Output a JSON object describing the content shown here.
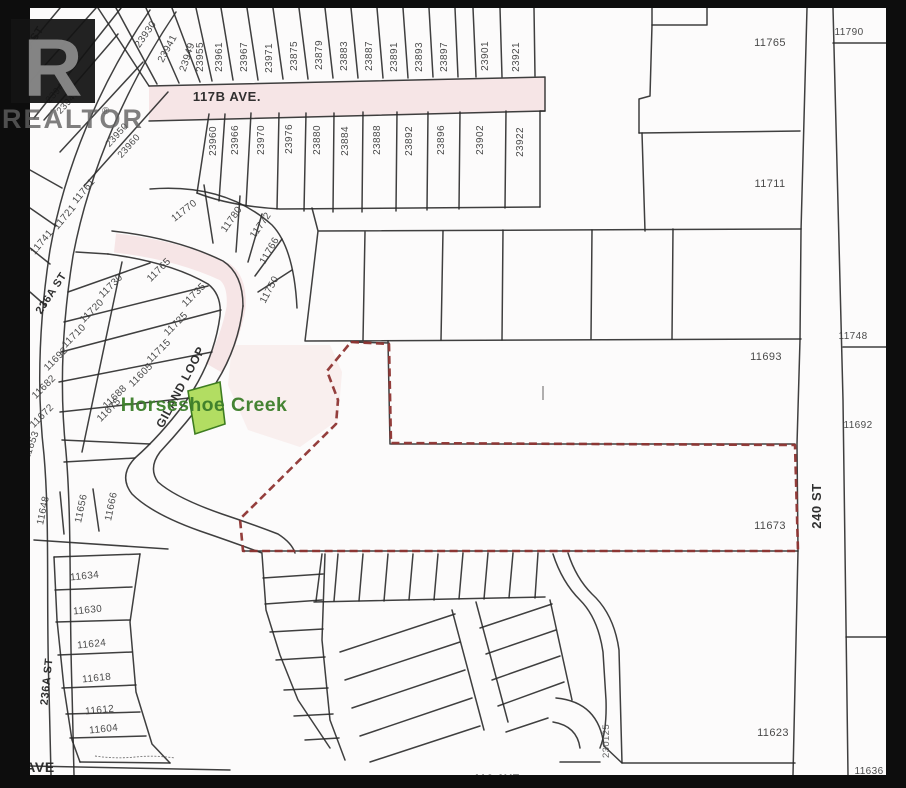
{
  "watermark": {
    "letter": "R",
    "text": "REALTOR",
    "reg": "®"
  },
  "subject_parcel": {
    "lot": "11673",
    "boundary_style": "red-dashed"
  },
  "poi": {
    "creek_label": "Horseshoe Creek"
  },
  "colors": {
    "frame": "#0d0d0d",
    "paper": "#fcfbfb",
    "parcel_line": "#2a2a2a",
    "boundary_dash": "#8e3432",
    "green_lot_fill": "#b2dd62",
    "green_lot_stroke": "#3e7d20",
    "creek_text": "#3c7e2a",
    "road_tint": "#f6e5e6"
  },
  "labels": [
    {
      "t": "117B AVE.",
      "x": 227,
      "y": 101,
      "r": 0,
      "s": 13,
      "cls": "street"
    },
    {
      "t": "240 ST",
      "x": 821,
      "y": 506,
      "r": -90,
      "s": 13,
      "cls": "street"
    },
    {
      "t": "236A ST",
      "x": 54,
      "y": 295,
      "r": -57,
      "s": 11,
      "cls": "street"
    },
    {
      "t": "236A ST",
      "x": 50,
      "y": 682,
      "r": -84,
      "s": 11,
      "cls": "street"
    },
    {
      "t": "GILAND LOOP",
      "x": 184,
      "y": 389,
      "r": -62,
      "s": 12,
      "cls": "street"
    },
    {
      "t": "9 ST",
      "x": 37,
      "y": 40,
      "r": -57,
      "s": 11,
      "cls": "street"
    },
    {
      "t": "AVE",
      "x": 40,
      "y": 772,
      "r": 0,
      "s": 14,
      "cls": "street"
    },
    {
      "t": "116 AVE",
      "x": 497,
      "y": 782,
      "r": 0,
      "s": 11,
      "cls": "street"
    },
    {
      "t": "Horseshoe Creek",
      "x": 204,
      "y": 411,
      "r": 0,
      "s": 19.5,
      "cls": "creek"
    },
    {
      "t": "23930",
      "x": 148,
      "y": 36,
      "r": -55,
      "s": 10,
      "cls": "lot"
    },
    {
      "t": "23941",
      "x": 170,
      "y": 50,
      "r": -62,
      "s": 10,
      "cls": "lot"
    },
    {
      "t": "23949",
      "x": 190,
      "y": 58,
      "r": -72,
      "s": 10,
      "cls": "lot"
    },
    {
      "t": "23955",
      "x": 203,
      "y": 57,
      "r": -90,
      "s": 10,
      "cls": "lot"
    },
    {
      "t": "23961",
      "x": 222,
      "y": 57,
      "r": -90,
      "s": 10,
      "cls": "lot"
    },
    {
      "t": "23967",
      "x": 247,
      "y": 57,
      "r": -90,
      "s": 10,
      "cls": "lot"
    },
    {
      "t": "23971",
      "x": 272,
      "y": 58,
      "r": -90,
      "s": 10,
      "cls": "lot"
    },
    {
      "t": "23875",
      "x": 297,
      "y": 56,
      "r": -90,
      "s": 10,
      "cls": "lot"
    },
    {
      "t": "23879",
      "x": 322,
      "y": 55,
      "r": -90,
      "s": 10,
      "cls": "lot"
    },
    {
      "t": "23883",
      "x": 347,
      "y": 56,
      "r": -90,
      "s": 10,
      "cls": "lot"
    },
    {
      "t": "23887",
      "x": 372,
      "y": 56,
      "r": -90,
      "s": 10,
      "cls": "lot"
    },
    {
      "t": "23891",
      "x": 397,
      "y": 57,
      "r": -90,
      "s": 10,
      "cls": "lot"
    },
    {
      "t": "23893",
      "x": 422,
      "y": 57,
      "r": -90,
      "s": 10,
      "cls": "lot"
    },
    {
      "t": "23897",
      "x": 447,
      "y": 57,
      "r": -90,
      "s": 10,
      "cls": "lot"
    },
    {
      "t": "23901",
      "x": 488,
      "y": 56,
      "r": -90,
      "s": 10,
      "cls": "lot"
    },
    {
      "t": "23921",
      "x": 519,
      "y": 57,
      "r": -90,
      "s": 10,
      "cls": "lot"
    },
    {
      "t": "23942",
      "x": 59,
      "y": 93,
      "r": -48,
      "s": 9.5,
      "cls": "lot"
    },
    {
      "t": "23940",
      "x": 70,
      "y": 104,
      "r": -48,
      "s": 9.5,
      "cls": "lot"
    },
    {
      "t": "23950",
      "x": 119,
      "y": 137,
      "r": -48,
      "s": 9.5,
      "cls": "lot"
    },
    {
      "t": "23960",
      "x": 131,
      "y": 148,
      "r": -48,
      "s": 9.5,
      "cls": "lot"
    },
    {
      "t": "23960",
      "x": 216,
      "y": 141,
      "r": -90,
      "s": 10,
      "cls": "lot"
    },
    {
      "t": "23966",
      "x": 238,
      "y": 140,
      "r": -90,
      "s": 10,
      "cls": "lot"
    },
    {
      "t": "23970",
      "x": 264,
      "y": 140,
      "r": -90,
      "s": 10,
      "cls": "lot"
    },
    {
      "t": "23976",
      "x": 292,
      "y": 139,
      "r": -90,
      "s": 10,
      "cls": "lot"
    },
    {
      "t": "23880",
      "x": 320,
      "y": 140,
      "r": -90,
      "s": 10,
      "cls": "lot"
    },
    {
      "t": "23884",
      "x": 348,
      "y": 141,
      "r": -90,
      "s": 10,
      "cls": "lot"
    },
    {
      "t": "23888",
      "x": 380,
      "y": 140,
      "r": -90,
      "s": 10,
      "cls": "lot"
    },
    {
      "t": "23892",
      "x": 412,
      "y": 141,
      "r": -90,
      "s": 10,
      "cls": "lot"
    },
    {
      "t": "23896",
      "x": 444,
      "y": 140,
      "r": -90,
      "s": 10,
      "cls": "lot"
    },
    {
      "t": "23902",
      "x": 483,
      "y": 140,
      "r": -90,
      "s": 10,
      "cls": "lot"
    },
    {
      "t": "23922",
      "x": 523,
      "y": 142,
      "r": -90,
      "s": 10,
      "cls": "lot"
    },
    {
      "t": "11770",
      "x": 186,
      "y": 213,
      "r": -38,
      "s": 10,
      "cls": "lot"
    },
    {
      "t": "11780",
      "x": 234,
      "y": 221,
      "r": -55,
      "s": 10,
      "cls": "lot"
    },
    {
      "t": "11772",
      "x": 263,
      "y": 227,
      "r": -55,
      "s": 10,
      "cls": "lot"
    },
    {
      "t": "11766",
      "x": 272,
      "y": 252,
      "r": -60,
      "s": 10,
      "cls": "lot"
    },
    {
      "t": "11750",
      "x": 272,
      "y": 291,
      "r": -62,
      "s": 10,
      "cls": "lot"
    },
    {
      "t": "11761",
      "x": 86,
      "y": 193,
      "r": -50,
      "s": 10,
      "cls": "lot"
    },
    {
      "t": "11721",
      "x": 67,
      "y": 219,
      "r": -50,
      "s": 10,
      "cls": "lot"
    },
    {
      "t": "11741",
      "x": 44,
      "y": 244,
      "r": -50,
      "s": 10,
      "cls": "lot"
    },
    {
      "t": "11730",
      "x": 113,
      "y": 288,
      "r": -45,
      "s": 10,
      "cls": "lot"
    },
    {
      "t": "11720",
      "x": 94,
      "y": 313,
      "r": -45,
      "s": 10,
      "cls": "lot"
    },
    {
      "t": "11710",
      "x": 76,
      "y": 338,
      "r": -45,
      "s": 10,
      "cls": "lot"
    },
    {
      "t": "11692",
      "x": 58,
      "y": 361,
      "r": -45,
      "s": 10,
      "cls": "lot"
    },
    {
      "t": "11682",
      "x": 46,
      "y": 389,
      "r": -45,
      "s": 10,
      "cls": "lot"
    },
    {
      "t": "11672",
      "x": 44,
      "y": 418,
      "r": -45,
      "s": 10,
      "cls": "lot"
    },
    {
      "t": "11653",
      "x": 34,
      "y": 446,
      "r": -70,
      "s": 10,
      "cls": "lot"
    },
    {
      "t": "11765",
      "x": 161,
      "y": 272,
      "r": -45,
      "s": 10,
      "cls": "lot"
    },
    {
      "t": "11735",
      "x": 196,
      "y": 297,
      "r": -45,
      "s": 10,
      "cls": "lot"
    },
    {
      "t": "11725",
      "x": 178,
      "y": 326,
      "r": -45,
      "s": 10,
      "cls": "lot"
    },
    {
      "t": "11715",
      "x": 161,
      "y": 353,
      "r": -45,
      "s": 10,
      "cls": "lot"
    },
    {
      "t": "11605",
      "x": 143,
      "y": 377,
      "r": -45,
      "s": 10,
      "cls": "lot"
    },
    {
      "t": "11688",
      "x": 117,
      "y": 399,
      "r": -45,
      "s": 10,
      "cls": "lot"
    },
    {
      "t": "11675",
      "x": 111,
      "y": 412,
      "r": -45,
      "s": 10,
      "cls": "lot"
    },
    {
      "t": "11765",
      "x": 770,
      "y": 46,
      "r": 0,
      "s": 11,
      "cls": "lot"
    },
    {
      "t": "11711",
      "x": 770,
      "y": 187,
      "r": 0,
      "s": 11,
      "cls": "lot"
    },
    {
      "t": "11693",
      "x": 766,
      "y": 360,
      "r": 0,
      "s": 11,
      "cls": "lot"
    },
    {
      "t": "11673",
      "x": 770,
      "y": 529,
      "r": 0,
      "s": 11,
      "cls": "lot"
    },
    {
      "t": "11623",
      "x": 773,
      "y": 736,
      "r": 0,
      "s": 11,
      "cls": "lot"
    },
    {
      "t": "11790",
      "x": 849,
      "y": 35,
      "r": 0,
      "s": 10,
      "cls": "lot"
    },
    {
      "t": "11748",
      "x": 853,
      "y": 339,
      "r": 0,
      "s": 10,
      "cls": "lot"
    },
    {
      "t": "11692",
      "x": 858,
      "y": 428,
      "r": 0,
      "s": 10,
      "cls": "lot"
    },
    {
      "t": "11636",
      "x": 869,
      "y": 774,
      "r": 0,
      "s": 10,
      "cls": "lot"
    },
    {
      "t": "230125",
      "x": 609,
      "y": 741,
      "r": -90,
      "s": 9.5,
      "cls": "plan"
    },
    {
      "t": "11648",
      "x": 46,
      "y": 511,
      "r": -78,
      "s": 10,
      "cls": "lot"
    },
    {
      "t": "11656",
      "x": 84,
      "y": 509,
      "r": -78,
      "s": 10,
      "cls": "lot"
    },
    {
      "t": "11666",
      "x": 114,
      "y": 507,
      "r": -78,
      "s": 10,
      "cls": "lot"
    },
    {
      "t": "11634",
      "x": 85,
      "y": 579,
      "r": -6,
      "s": 10,
      "cls": "lot"
    },
    {
      "t": "11630",
      "x": 88,
      "y": 613,
      "r": -6,
      "s": 10,
      "cls": "lot"
    },
    {
      "t": "11624",
      "x": 92,
      "y": 647,
      "r": -6,
      "s": 10,
      "cls": "lot"
    },
    {
      "t": "11618",
      "x": 97,
      "y": 681,
      "r": -6,
      "s": 10,
      "cls": "lot"
    },
    {
      "t": "11612",
      "x": 100,
      "y": 713,
      "r": -6,
      "s": 10,
      "cls": "lot"
    },
    {
      "t": "11604",
      "x": 104,
      "y": 732,
      "r": -6,
      "s": 10,
      "cls": "lot"
    }
  ]
}
